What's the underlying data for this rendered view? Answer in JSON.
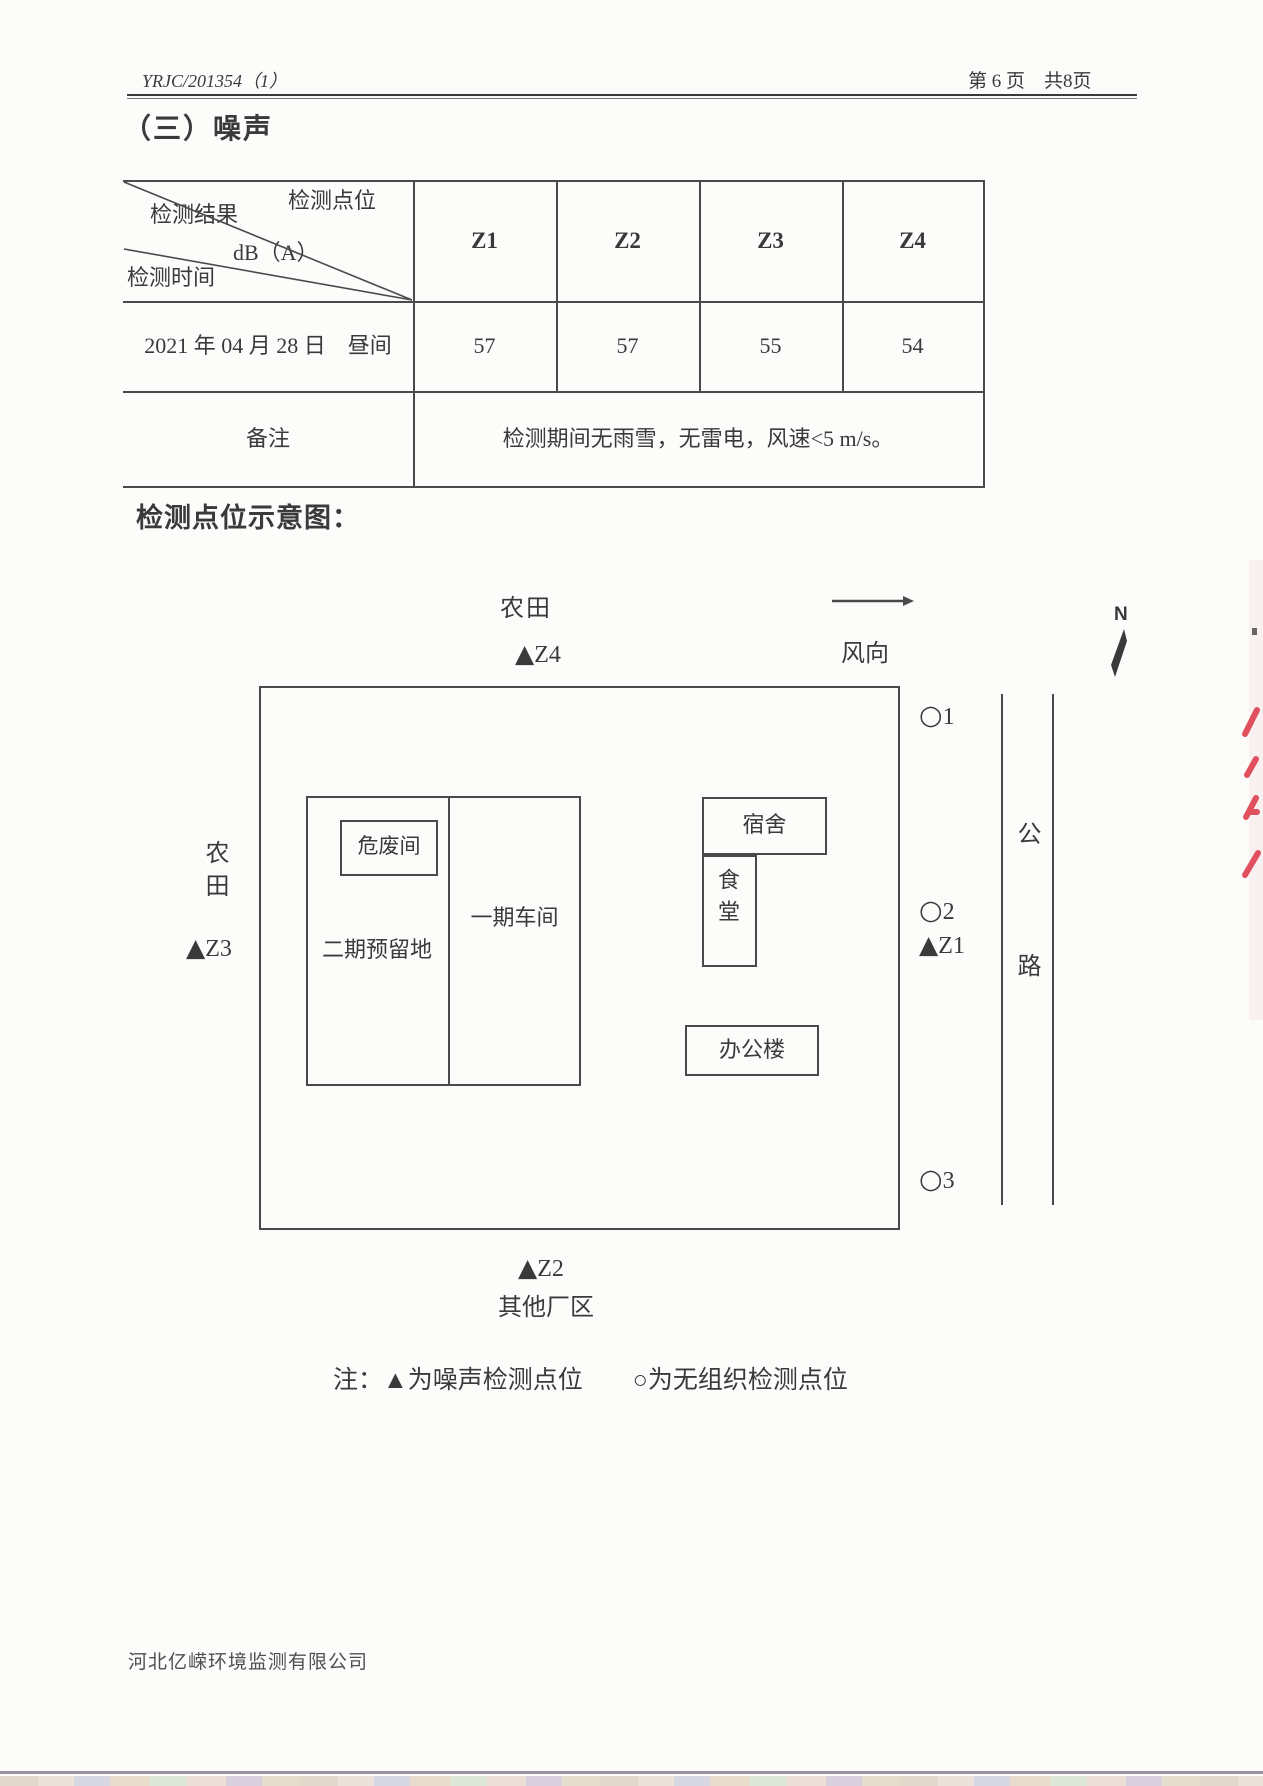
{
  "page": {
    "header_left": "YRJC/201354（1）",
    "header_right": "第 6 页　共8页",
    "section_title": "（三）噪声",
    "diagram_heading": "检测点位示意图：",
    "note": "注：▲为噪声检测点位　　○为无组织检测点位",
    "footer_company": "河北亿嵘环境监测有限公司"
  },
  "noise_table": {
    "corner_labels": {
      "result": "检测结果",
      "point": "检测点位",
      "unit": "dB（A）",
      "time": "检测时间"
    },
    "point_columns": [
      "Z1",
      "Z2",
      "Z3",
      "Z4"
    ],
    "data_row": {
      "time": "2021 年 04 月 28 日　昼间",
      "values": [
        "57",
        "57",
        "55",
        "54"
      ]
    },
    "remark_label": "备注",
    "remark_text": "检测期间无雨雪，无雷电，风速<5 m/s。"
  },
  "diagram": {
    "farmland_top": "农田",
    "farmland_left": "农田",
    "wind_label": "风向",
    "compass_label": "N",
    "road_label": "公路",
    "other_area": "其他厂区",
    "buildings": {
      "hazardous_waste": "危废间",
      "phase2_reserved": "二期预留地",
      "phase1_workshop": "一期车间",
      "dormitory": "宿舍",
      "canteen": "食堂",
      "office": "办公楼"
    },
    "points": {
      "z1": {
        "marker": "▲",
        "label": "Z1"
      },
      "z2": {
        "marker": "▲",
        "label": "Z2"
      },
      "z3": {
        "marker": "▲",
        "label": "Z3"
      },
      "z4": {
        "marker": "▲",
        "label": "Z4"
      },
      "o1": {
        "marker": "○",
        "label": "1"
      },
      "o2": {
        "marker": "○",
        "label": "2"
      },
      "o3": {
        "marker": "○",
        "label": "3"
      }
    }
  },
  "colors": {
    "ink": "#3a3a3a",
    "line": "#4a4a4a",
    "red_mark": "#e0505e"
  }
}
